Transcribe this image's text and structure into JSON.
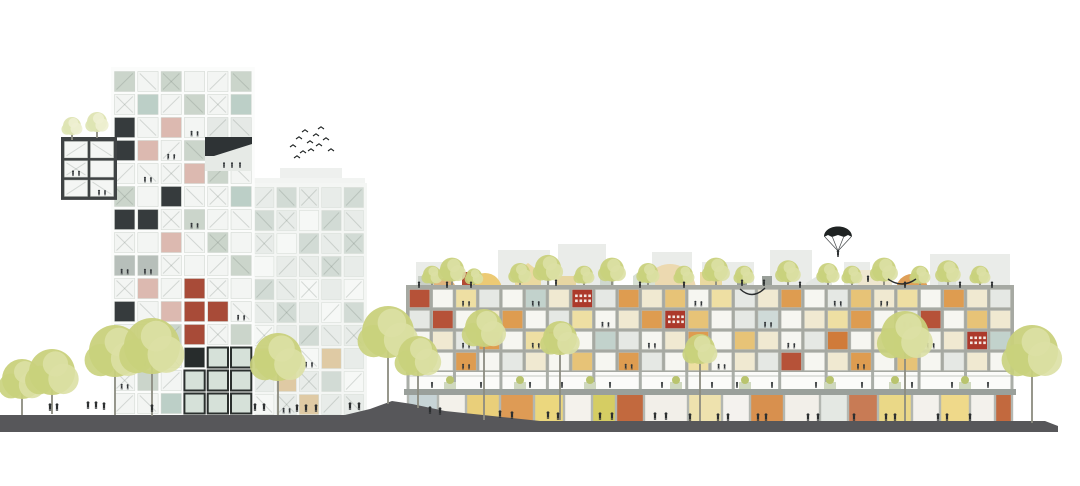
{
  "meta": {
    "type": "architectural-elevation-illustration",
    "width": 1080,
    "height": 486,
    "background": "#ffffff",
    "ink": "#2c2f30",
    "tree_colors": {
      "c1": "#c9d17c",
      "c2": "#dbe0a4",
      "pale1": "#dee4b2",
      "pale2": "#eef0d2",
      "trunk": "#8c8c80"
    }
  },
  "ground": {
    "color": "#57575a",
    "points": [
      [
        0,
        415
      ],
      [
        345,
        415
      ],
      [
        370,
        409
      ],
      [
        392,
        401
      ],
      [
        412,
        404
      ],
      [
        445,
        411
      ],
      [
        540,
        421
      ],
      [
        1045,
        421
      ],
      [
        1058,
        426
      ],
      [
        1058,
        432
      ],
      [
        0,
        432
      ]
    ]
  },
  "background_blocks": {
    "color": "#eaece9",
    "rects": [
      {
        "x": 416,
        "y": 262,
        "w": 36,
        "h": 28
      },
      {
        "x": 498,
        "y": 250,
        "w": 52,
        "h": 40
      },
      {
        "x": 558,
        "y": 244,
        "w": 48,
        "h": 46
      },
      {
        "x": 652,
        "y": 252,
        "w": 40,
        "h": 38
      },
      {
        "x": 702,
        "y": 262,
        "w": 52,
        "h": 28
      },
      {
        "x": 770,
        "y": 250,
        "w": 42,
        "h": 40
      },
      {
        "x": 844,
        "y": 262,
        "w": 26,
        "h": 28
      },
      {
        "x": 930,
        "y": 254,
        "w": 80,
        "h": 36
      }
    ],
    "gables": [
      {
        "x": 806,
        "y": 295,
        "w": 26,
        "h": 12,
        "peak": 8,
        "c": "#e2e6e2"
      },
      {
        "x": 855,
        "y": 295,
        "w": 24,
        "h": 10,
        "peak": 7,
        "c": "#e6eae6"
      }
    ]
  },
  "arches": [
    {
      "cx": 444,
      "r": 12,
      "base": 290,
      "c": "#e0b47c"
    },
    {
      "cx": 485,
      "r": 17,
      "base": 290,
      "c": "#ecca74"
    },
    {
      "cx": 670,
      "r": 26,
      "base": 290,
      "c": "#ecd9b0"
    },
    {
      "cx": 912,
      "r": 16,
      "base": 290,
      "c": "#df9f58"
    }
  ],
  "roof_gable_boxes": [
    {
      "x": 515,
      "y": 273,
      "w": 26,
      "h": 17,
      "peak": 10,
      "c": "#ead9a0"
    },
    {
      "x": 633,
      "y": 276,
      "w": 22,
      "h": 14,
      "peak": 8,
      "c": "#d8e0d4"
    }
  ],
  "roof_boxes": [
    {
      "x": 418,
      "y": 276,
      "w": 16,
      "h": 12,
      "c": "#c9cfc8"
    },
    {
      "x": 462,
      "y": 272,
      "w": 10,
      "h": 16,
      "c": "#b24a34"
    },
    {
      "x": 556,
      "y": 276,
      "w": 20,
      "h": 12,
      "c": "#e7d6a2"
    },
    {
      "x": 600,
      "y": 270,
      "w": 14,
      "h": 18,
      "c": "#cfd8cf"
    },
    {
      "x": 700,
      "y": 272,
      "w": 22,
      "h": 16,
      "c": "#ead9a0"
    },
    {
      "x": 737,
      "y": 276,
      "w": 10,
      "h": 13,
      "c": "#9aa09a"
    },
    {
      "x": 762,
      "y": 276,
      "w": 10,
      "h": 13,
      "c": "#9aa09a"
    },
    {
      "x": 858,
      "y": 270,
      "w": 34,
      "h": 19,
      "c": "#efe7d0"
    },
    {
      "x": 938,
      "y": 276,
      "w": 18,
      "h": 12,
      "c": "#dde2dc"
    }
  ],
  "roof_trees": [
    {
      "x": 432,
      "r": 9
    },
    {
      "x": 452,
      "r": 12
    },
    {
      "x": 474,
      "r": 8
    },
    {
      "x": 520,
      "r": 10
    },
    {
      "x": 548,
      "r": 13
    },
    {
      "x": 584,
      "r": 9
    },
    {
      "x": 612,
      "r": 12
    },
    {
      "x": 648,
      "r": 10
    },
    {
      "x": 684,
      "r": 9
    },
    {
      "x": 716,
      "r": 12
    },
    {
      "x": 744,
      "r": 9
    },
    {
      "x": 788,
      "r": 11
    },
    {
      "x": 828,
      "r": 10
    },
    {
      "x": 852,
      "r": 9
    },
    {
      "x": 884,
      "r": 12
    },
    {
      "x": 920,
      "r": 9
    },
    {
      "x": 948,
      "r": 11
    },
    {
      "x": 980,
      "r": 9
    }
  ],
  "buildings": {
    "tower": {
      "x": 113,
      "y": 70,
      "cols": 6,
      "rows": 15,
      "cw": 23.3,
      "ch": 23,
      "frame": "#fbfcfb",
      "cell_stroke": "#ccd2cc",
      "texture": true,
      "palette": {
        "w": "#f3f5f3",
        "s": "#cbd5cb",
        "t": "#bccfc7",
        "d": "#363b3d",
        "p": "#dcb9b0",
        "r": "#a84b38",
        "c": "#e9e1c6",
        "G": "#d6e1d9",
        "y": "#e5e9e6",
        "k": "#272c2c",
        "m": "#b7bfba"
      },
      "rows_data": [
        "swswws",
        "wtwswt",
        "dwpwyy",
        "dpwsyy",
        "wwwpsw",
        "swdwwt",
        "ddwsww",
        "wwpwsw",
        "mmwwws",
        "wpwrww",
        "dwprrw",
        "wwsrws",
        "swwkGG",
        "wswGGG",
        "wwtGGG"
      ],
      "marks": [
        [
          2,
          3
        ],
        [
          3,
          2
        ],
        [
          4,
          1
        ],
        [
          6,
          3
        ],
        [
          8,
          0
        ],
        [
          8,
          1
        ],
        [
          10,
          5
        ],
        [
          12,
          1
        ],
        [
          13,
          0
        ]
      ]
    },
    "annex": {
      "x": 63,
      "y": 140,
      "cols": 2,
      "rows": 3,
      "cw": 26,
      "ch": 19.3,
      "frame": "#3f4344",
      "cell_stroke": "#c9cfc9",
      "texture": true,
      "palette": {
        "w": "#f4f6f4"
      },
      "rows_data": [
        "ww",
        "ww",
        "ww"
      ],
      "marks": [
        [
          1,
          0
        ],
        [
          2,
          1
        ]
      ]
    },
    "mid_tower": {
      "x": 253,
      "y": 186,
      "cols": 5,
      "rows": 10,
      "cw": 22.4,
      "ch": 23,
      "frame": "#f4f6f4",
      "cell_stroke": "#d4dad4",
      "texture": true,
      "palette": {
        "a": "#e8ece9",
        "b": "#d2dbd5",
        "w": "#f6f8f6",
        "n": "#dfcaa4"
      },
      "rows_data": [
        "abaab",
        "bawba",
        "awbab",
        "waaba",
        "bawaw",
        "abawb",
        "wabaa",
        "nawna",
        "anabw",
        "wanaa"
      ],
      "marks": [
        [
          7,
          2
        ],
        [
          9,
          1
        ]
      ]
    },
    "complex": {
      "x": 408,
      "y": 288,
      "cols": 26,
      "rows": 4,
      "cw": 23.23,
      "ch": 21,
      "frame": "#a6a9a2",
      "cell_stroke": "#b9bcb5",
      "texture": false,
      "palette": {
        "W": "#f6f6f1",
        "c": "#f0e9d1",
        "y": "#eedfa3",
        "a": "#e7c377",
        "o": "#de9c50",
        "O": "#d07b3a",
        "r": "#b65238",
        "R": "#ac392b",
        "g": "#e5e8e4",
        "t": "#c2d2cc",
        "n": "#dcc59d",
        "h": "#cfdad8"
      },
      "rows_data": [
        "rWygWtcRgocaWygcoWgacyWocg",
        "grWcoWgyWcoRaWghWcyoWgrWac",
        "WcgoWyrWtgWcoWacWgOWcnWcRt",
        "cWoWgcWaWogWyWcgrWcoWaWgcW"
      ],
      "marks": [
        [
          0,
          2
        ],
        [
          0,
          5
        ],
        [
          0,
          12
        ],
        [
          0,
          18
        ],
        [
          0,
          20
        ],
        [
          1,
          3
        ],
        [
          1,
          8
        ],
        [
          1,
          15
        ],
        [
          1,
          21
        ],
        [
          2,
          2
        ],
        [
          2,
          5
        ],
        [
          2,
          10
        ],
        [
          2,
          16
        ],
        [
          2,
          22
        ],
        [
          3,
          2
        ],
        [
          3,
          9
        ],
        [
          3,
          13
        ],
        [
          3,
          19
        ]
      ]
    }
  },
  "mid_tower_parapet": [
    {
      "x": 280,
      "y": 168,
      "w": 62,
      "h": 17,
      "c": "#eef0ee"
    },
    {
      "x": 253,
      "y": 178,
      "w": 112,
      "h": 8,
      "c": "#f2f4f2"
    }
  ],
  "tower_notch": {
    "rect": {
      "x": 205,
      "y": 137,
      "w": 47,
      "h": 34,
      "c": "#e6eae6"
    },
    "wedge": {
      "points": [
        [
          205,
          137
        ],
        [
          252,
          137
        ],
        [
          252,
          144
        ],
        [
          214,
          156
        ],
        [
          205,
          156
        ]
      ],
      "c": "#2e3335"
    },
    "people": [
      [
        224,
        168
      ],
      [
        232,
        168
      ],
      [
        240,
        168
      ]
    ]
  },
  "terrace": {
    "x": 408,
    "w": 604,
    "y": 372,
    "h": 18,
    "bg": "#fbfbf9",
    "column_color": "#aaaea8",
    "column_step": 46.46,
    "rail_color": "#c6cac4",
    "planters": [
      450,
      520,
      590,
      676,
      745,
      830,
      895,
      965
    ],
    "planter_colors": {
      "box": "#cfd8bf",
      "leaf": "#b9c46e"
    }
  },
  "slab": {
    "x": 404,
    "y": 389,
    "w": 612,
    "h": 6,
    "c": "#9aa09b"
  },
  "storefronts": {
    "y": 395,
    "h": 28,
    "pier_color": "#b3b7b1",
    "panels": [
      {
        "x": 408,
        "w": 30,
        "c": "#c7d4d6"
      },
      {
        "x": 438,
        "w": 28,
        "c": "#f3f1ea"
      },
      {
        "x": 466,
        "w": 34,
        "c": "#e9cf7a"
      },
      {
        "x": 500,
        "w": 34,
        "c": "#de9b55"
      },
      {
        "x": 534,
        "w": 30,
        "c": "#ebd77e"
      },
      {
        "x": 564,
        "w": 28,
        "c": "#f4f2ec"
      },
      {
        "x": 592,
        "w": 24,
        "c": "#d5cd63"
      },
      {
        "x": 616,
        "w": 28,
        "c": "#c2693e"
      },
      {
        "x": 644,
        "w": 44,
        "c": "#f2efe9"
      },
      {
        "x": 688,
        "w": 34,
        "c": "#eee2ae"
      },
      {
        "x": 722,
        "w": 28,
        "c": "#f4f2ee"
      },
      {
        "x": 750,
        "w": 34,
        "c": "#d8904e"
      },
      {
        "x": 784,
        "w": 36,
        "c": "#f2efe9"
      },
      {
        "x": 820,
        "w": 28,
        "c": "#e4e8e3"
      },
      {
        "x": 848,
        "w": 30,
        "c": "#c87b55"
      },
      {
        "x": 878,
        "w": 34,
        "c": "#ead887"
      },
      {
        "x": 912,
        "w": 28,
        "c": "#f3f1ec"
      },
      {
        "x": 940,
        "w": 30,
        "c": "#efd98a"
      },
      {
        "x": 970,
        "w": 25,
        "c": "#f3f1ec"
      },
      {
        "x": 995,
        "w": 17,
        "c": "#c2693e"
      }
    ]
  },
  "annex_roof_trees": [
    {
      "x": 72,
      "y": 140,
      "r": 9,
      "h": 14
    },
    {
      "x": 97,
      "y": 138,
      "r": 10,
      "h": 16
    }
  ],
  "trees": [
    {
      "x": 22,
      "y": 415,
      "r": 20,
      "h": 36
    },
    {
      "x": 52,
      "y": 414,
      "r": 23,
      "h": 42
    },
    {
      "x": 115,
      "y": 415,
      "r": 26,
      "h": 64
    },
    {
      "x": 152,
      "y": 416,
      "r": 28,
      "h": 70
    },
    {
      "x": 278,
      "y": 415,
      "r": 24,
      "h": 58
    },
    {
      "x": 388,
      "y": 404,
      "r": 26,
      "h": 72
    },
    {
      "x": 418,
      "y": 408,
      "r": 20,
      "h": 52
    },
    {
      "x": 484,
      "y": 420,
      "r": 19,
      "h": 92
    },
    {
      "x": 560,
      "y": 420,
      "r": 17,
      "h": 82
    },
    {
      "x": 700,
      "y": 421,
      "r": 15,
      "h": 72
    },
    {
      "x": 905,
      "y": 421,
      "r": 24,
      "h": 86
    },
    {
      "x": 1032,
      "y": 423,
      "r": 26,
      "h": 72
    }
  ],
  "people": {
    "ground": [
      [
        50,
        411
      ],
      [
        57,
        411
      ],
      [
        88,
        409
      ],
      [
        96,
        409
      ],
      [
        104,
        410
      ],
      [
        152,
        412
      ],
      [
        255,
        411
      ],
      [
        264,
        411
      ],
      [
        297,
        412
      ],
      [
        306,
        412
      ],
      [
        316,
        412
      ],
      [
        350,
        410
      ],
      [
        359,
        410
      ],
      [
        430,
        414
      ],
      [
        440,
        415
      ],
      [
        500,
        418
      ],
      [
        512,
        419
      ],
      [
        548,
        419
      ],
      [
        558,
        420
      ],
      [
        600,
        420
      ],
      [
        612,
        420
      ],
      [
        655,
        420
      ],
      [
        666,
        420
      ],
      [
        690,
        421
      ],
      [
        718,
        421
      ],
      [
        728,
        421
      ],
      [
        758,
        421
      ],
      [
        766,
        421
      ],
      [
        808,
        421
      ],
      [
        818,
        421
      ],
      [
        854,
        421
      ],
      [
        886,
        421
      ],
      [
        895,
        421
      ],
      [
        938,
        421
      ],
      [
        947,
        421
      ],
      [
        970,
        421
      ]
    ],
    "roof": [
      [
        419,
        288
      ],
      [
        447,
        288
      ],
      [
        471,
        288
      ],
      [
        556,
        286
      ],
      [
        640,
        288
      ],
      [
        684,
        288
      ],
      [
        742,
        286
      ],
      [
        764,
        286
      ],
      [
        800,
        288
      ],
      [
        868,
        282
      ],
      [
        905,
        288
      ],
      [
        960,
        288
      ],
      [
        992,
        288
      ]
    ],
    "terrace": [
      [
        432,
        388
      ],
      [
        481,
        388
      ],
      [
        530,
        388
      ],
      [
        562,
        388
      ],
      [
        610,
        388
      ],
      [
        662,
        388
      ],
      [
        712,
        388
      ],
      [
        737,
        388
      ],
      [
        772,
        388
      ],
      [
        816,
        388
      ],
      [
        862,
        388
      ],
      [
        912,
        388
      ],
      [
        952,
        388
      ],
      [
        988,
        388
      ]
    ]
  },
  "birds": [
    [
      293,
      147
    ],
    [
      299,
      139
    ],
    [
      305,
      132
    ],
    [
      310,
      143
    ],
    [
      316,
      136
    ],
    [
      321,
      129
    ],
    [
      303,
      153
    ],
    [
      311,
      151
    ],
    [
      319,
      146
    ],
    [
      326,
      140
    ],
    [
      331,
      151
    ],
    [
      297,
      158
    ]
  ],
  "parachute": {
    "cx": 838,
    "top": 223,
    "half": 14,
    "canopy_bottom": 237,
    "person_y": 257,
    "canopy_color": "#1e2222",
    "line_color": "#44484a"
  },
  "hammocks": [
    {
      "x1": 888,
      "y1": 279,
      "x2": 916,
      "y2": 279,
      "dip": 10
    },
    {
      "x1": 740,
      "y1": 289,
      "x2": 765,
      "y2": 288,
      "dip": 12
    }
  ]
}
